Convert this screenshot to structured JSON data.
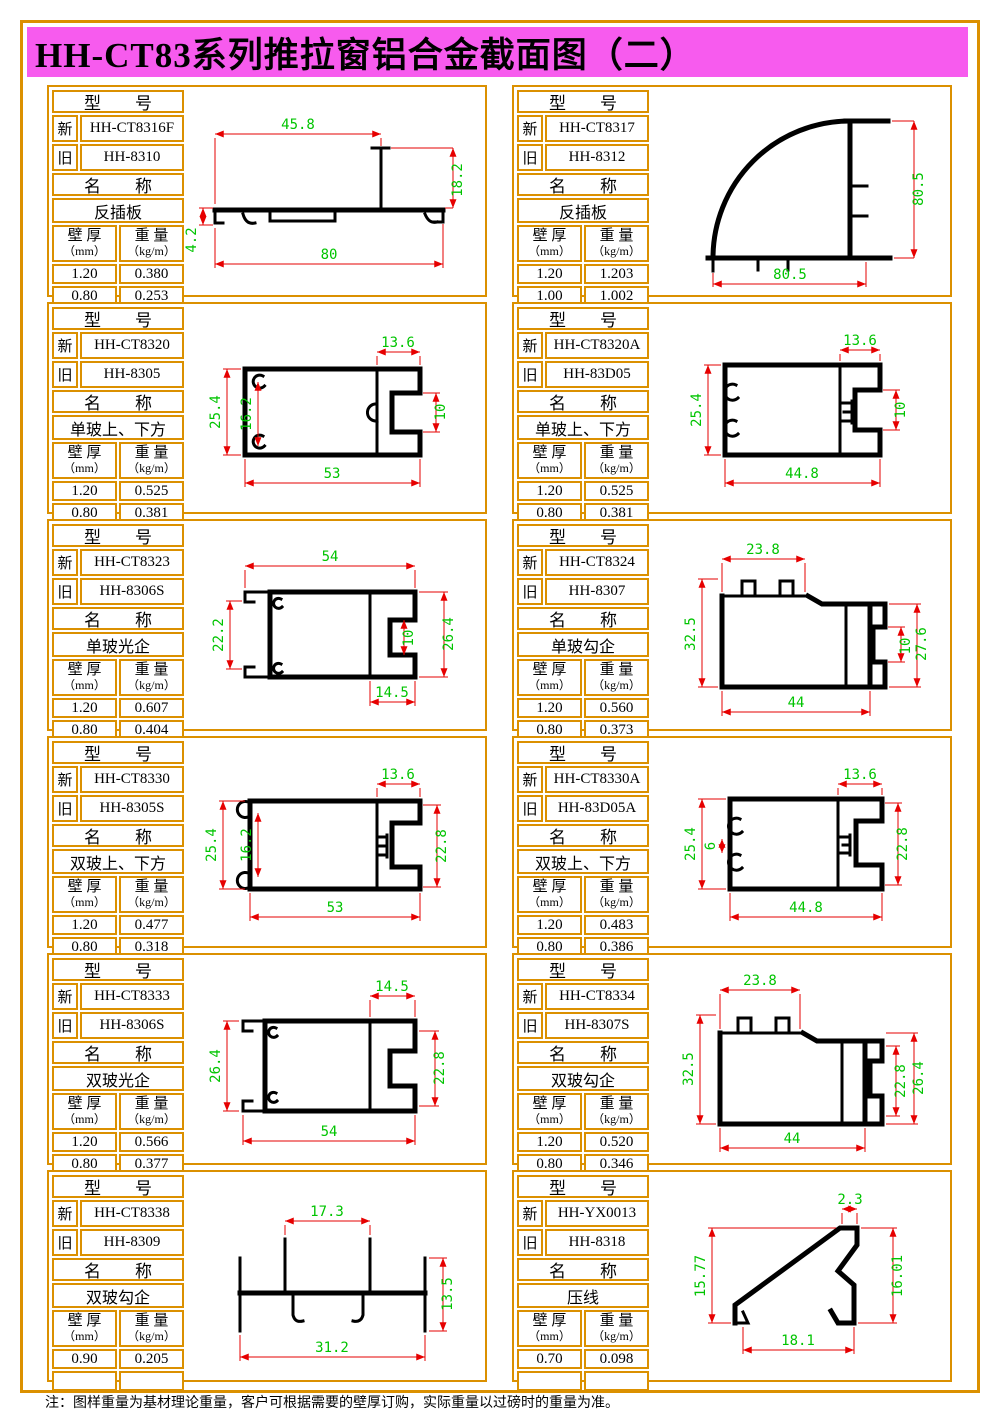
{
  "page": {
    "title": "HH-CT83系列推拉窗铝合金截面图（二）",
    "footnote": "注：图样重量为基材理论重量，客户可根据需要的壁厚订购，实际重量以过磅时的重量为准。"
  },
  "colors": {
    "banner": "#F75BEE",
    "frame_orange": "#DB9000",
    "dimension_line_red": "#E60000",
    "dimension_text_green": "#00C400",
    "profile_black": "#000000"
  },
  "labels": {
    "model_header": "型　　号",
    "new": "新",
    "old": "旧",
    "name_header": "名　　称",
    "thickness": "壁 厚",
    "thickness_unit": "（mm）",
    "weight": "重 量",
    "weight_unit": "（kg/m）"
  },
  "cells": [
    {
      "model_new": "HH-CT8316F",
      "model_old": "HH-8310",
      "name": "反插板",
      "rows": [
        [
          "1.20",
          "0.380"
        ],
        [
          "0.80",
          "0.253"
        ]
      ],
      "dims": [
        {
          "value": "45.8",
          "edge": "top"
        },
        {
          "value": "18.2",
          "edge": "right"
        },
        {
          "value": "4.2",
          "edge": "left"
        },
        {
          "value": "80",
          "edge": "bottom"
        }
      ]
    },
    {
      "model_new": "HH-CT8317",
      "model_old": "HH-8312",
      "name": "反插板",
      "rows": [
        [
          "1.20",
          "1.203"
        ],
        [
          "1.00",
          "1.002"
        ]
      ],
      "dims": [
        {
          "value": "80.5",
          "edge": "right"
        },
        {
          "value": "80.5",
          "edge": "bottom"
        }
      ]
    },
    {
      "model_new": "HH-CT8320",
      "model_old": "HH-8305",
      "name": "单玻上、下方",
      "rows": [
        [
          "1.20",
          "0.525"
        ],
        [
          "0.80",
          "0.381"
        ]
      ],
      "dims": [
        {
          "value": "13.6",
          "edge": "top"
        },
        {
          "value": "25.4",
          "edge": "left"
        },
        {
          "value": "16.2",
          "edge": "inner-left"
        },
        {
          "value": "10",
          "edge": "right"
        },
        {
          "value": "53",
          "edge": "bottom"
        }
      ]
    },
    {
      "model_new": "HH-CT8320A",
      "model_old": "HH-83D05",
      "name": "单玻上、下方",
      "rows": [
        [
          "1.20",
          "0.525"
        ],
        [
          "0.80",
          "0.381"
        ]
      ],
      "dims": [
        {
          "value": "13.6",
          "edge": "top"
        },
        {
          "value": "25.4",
          "edge": "left"
        },
        {
          "value": "10",
          "edge": "right"
        },
        {
          "value": "44.8",
          "edge": "bottom"
        }
      ]
    },
    {
      "model_new": "HH-CT8323",
      "model_old": "HH-8306S",
      "name": "单玻光企",
      "rows": [
        [
          "1.20",
          "0.607"
        ],
        [
          "0.80",
          "0.404"
        ]
      ],
      "dims": [
        {
          "value": "54",
          "edge": "top"
        },
        {
          "value": "22.2",
          "edge": "left"
        },
        {
          "value": "10",
          "edge": "inner-right"
        },
        {
          "value": "26.4",
          "edge": "right"
        },
        {
          "value": "14.5",
          "edge": "bottom"
        }
      ]
    },
    {
      "model_new": "HH-CT8324",
      "model_old": "HH-8307",
      "name": "单玻勾企",
      "rows": [
        [
          "1.20",
          "0.560"
        ],
        [
          "0.80",
          "0.373"
        ]
      ],
      "dims": [
        {
          "value": "23.8",
          "edge": "top"
        },
        {
          "value": "32.5",
          "edge": "left"
        },
        {
          "value": "10",
          "edge": "inner-right"
        },
        {
          "value": "27.6",
          "edge": "right"
        },
        {
          "value": "44",
          "edge": "bottom"
        }
      ]
    },
    {
      "model_new": "HH-CT8330",
      "model_old": "HH-8305S",
      "name": "双玻上、下方",
      "rows": [
        [
          "1.20",
          "0.477"
        ],
        [
          "0.80",
          "0.318"
        ]
      ],
      "dims": [
        {
          "value": "13.6",
          "edge": "top"
        },
        {
          "value": "25.4",
          "edge": "left"
        },
        {
          "value": "16.2",
          "edge": "inner-left"
        },
        {
          "value": "22.8",
          "edge": "right"
        },
        {
          "value": "53",
          "edge": "bottom"
        }
      ]
    },
    {
      "model_new": "HH-CT8330A",
      "model_old": "HH-83D05A",
      "name": "双玻上、下方",
      "rows": [
        [
          "1.20",
          "0.483"
        ],
        [
          "0.80",
          "0.386"
        ]
      ],
      "dims": [
        {
          "value": "13.6",
          "edge": "top"
        },
        {
          "value": "25.4",
          "edge": "left"
        },
        {
          "value": "6",
          "edge": "inner-left"
        },
        {
          "value": "22.8",
          "edge": "right"
        },
        {
          "value": "44.8",
          "edge": "bottom"
        }
      ]
    },
    {
      "model_new": "HH-CT8333",
      "model_old": "HH-8306S",
      "name": "双玻光企",
      "rows": [
        [
          "1.20",
          "0.566"
        ],
        [
          "0.80",
          "0.377"
        ]
      ],
      "dims": [
        {
          "value": "14.5",
          "edge": "top"
        },
        {
          "value": "26.4",
          "edge": "left"
        },
        {
          "value": "22.8",
          "edge": "right"
        },
        {
          "value": "54",
          "edge": "bottom"
        }
      ]
    },
    {
      "model_new": "HH-CT8334",
      "model_old": "HH-8307S",
      "name": "双玻勾企",
      "rows": [
        [
          "1.20",
          "0.520"
        ],
        [
          "0.80",
          "0.346"
        ]
      ],
      "dims": [
        {
          "value": "23.8",
          "edge": "top"
        },
        {
          "value": "32.5",
          "edge": "left"
        },
        {
          "value": "22.8",
          "edge": "inner-right"
        },
        {
          "value": "26.4",
          "edge": "right"
        },
        {
          "value": "44",
          "edge": "bottom"
        }
      ]
    },
    {
      "model_new": "HH-CT8338",
      "model_old": "HH-8309",
      "name": "双玻勾企",
      "rows": [
        [
          "0.90",
          "0.205"
        ],
        [
          "",
          ""
        ]
      ],
      "dims": [
        {
          "value": "17.3",
          "edge": "top"
        },
        {
          "value": "13.5",
          "edge": "right"
        },
        {
          "value": "31.2",
          "edge": "bottom"
        }
      ]
    },
    {
      "model_new": "HH-YX0013",
      "model_old": "HH-8318",
      "name": "压线",
      "rows": [
        [
          "0.70",
          "0.098"
        ],
        [
          "",
          ""
        ]
      ],
      "dims": [
        {
          "value": "2.3",
          "edge": "top"
        },
        {
          "value": "15.77",
          "edge": "left"
        },
        {
          "value": "16.01",
          "edge": "right"
        },
        {
          "value": "18.1",
          "edge": "bottom"
        }
      ]
    }
  ]
}
